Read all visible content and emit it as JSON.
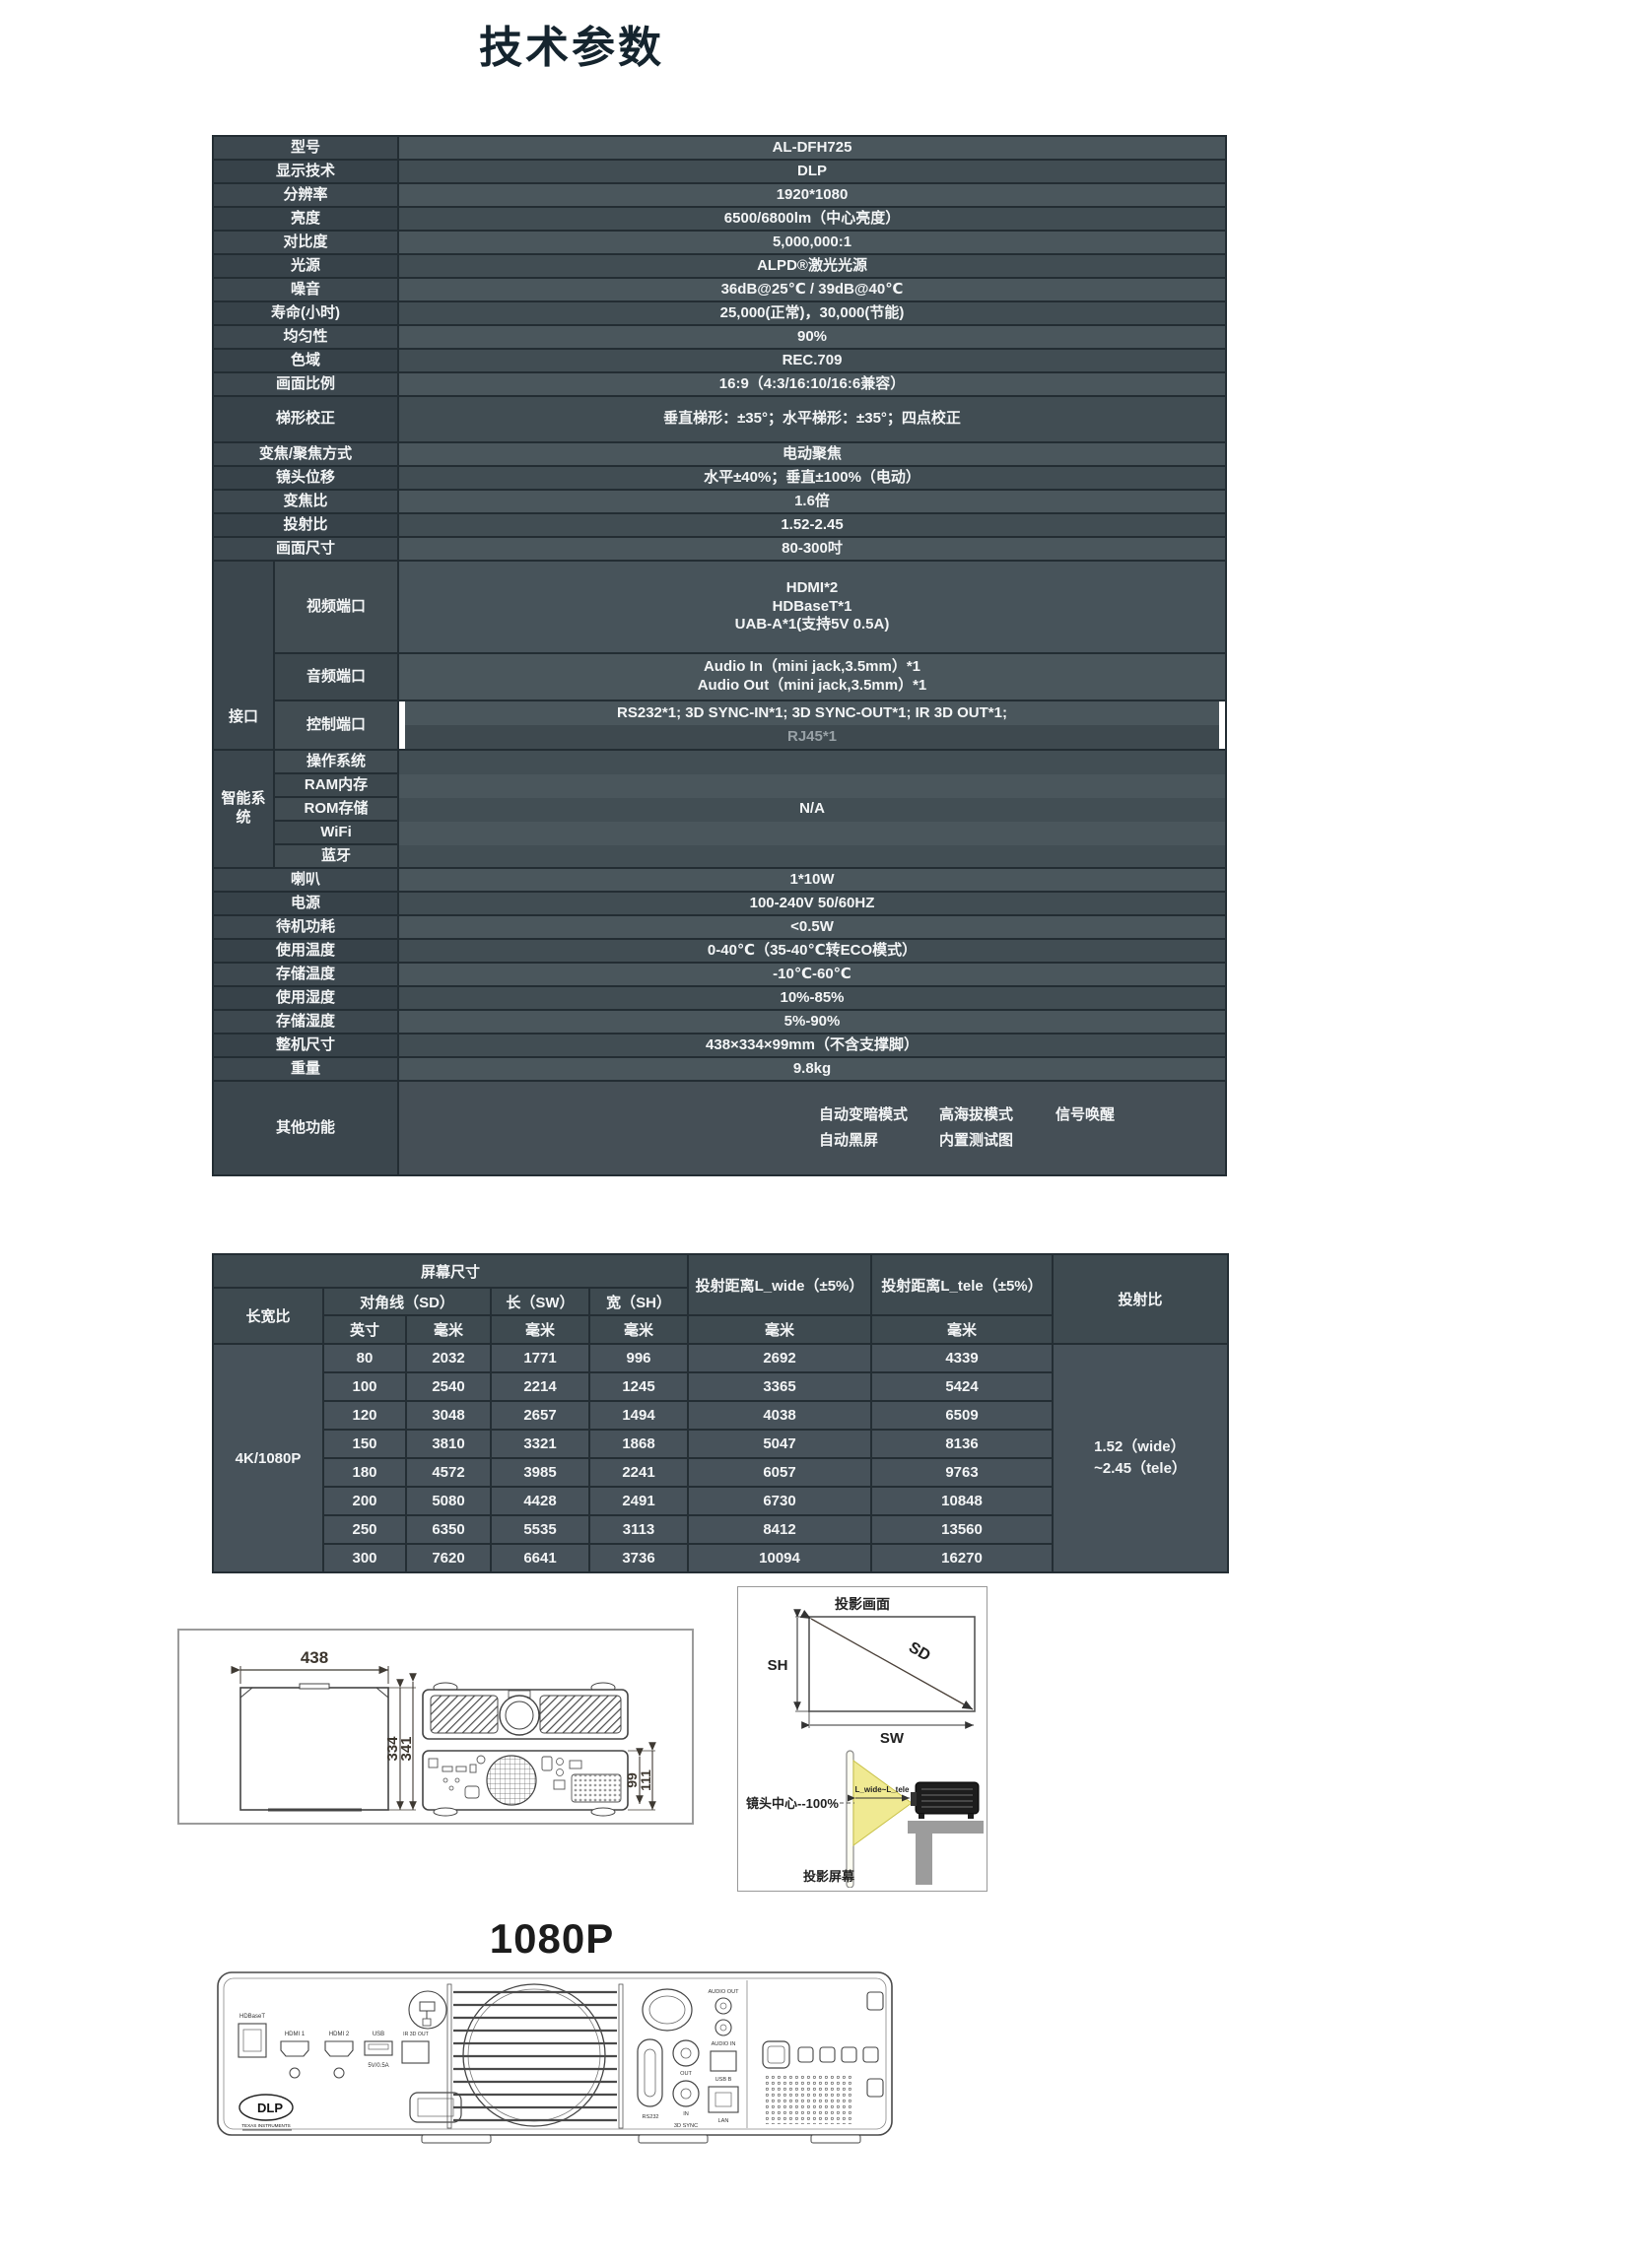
{
  "page": {
    "title": "技术参数",
    "model_banner": "1080P"
  },
  "spec_table": {
    "rows1": [
      {
        "label": "型号",
        "value": "AL-DFH725"
      },
      {
        "label": "显示技术",
        "value": "DLP"
      },
      {
        "label": "分辨率",
        "value": "1920*1080"
      },
      {
        "label": "亮度",
        "value": "6500/6800lm（中心亮度）"
      },
      {
        "label": "对比度",
        "value": "5,000,000:1"
      },
      {
        "label": "光源",
        "value": "ALPD®激光光源"
      },
      {
        "label": "噪音",
        "value": "36dB@25℃ / 39dB@40℃"
      },
      {
        "label": "寿命(小时)",
        "value": "25,000(正常)，30,000(节能)"
      },
      {
        "label": "均匀性",
        "value": "90%"
      },
      {
        "label": "色域",
        "value": "REC.709"
      },
      {
        "label": "画面比例",
        "value": "16:9（4:3/16:10/16:6兼容）"
      },
      {
        "label": "梯形校正",
        "value": "垂直梯形：±35°；水平梯形：±35°；四点校正"
      },
      {
        "label": "变焦/聚焦方式",
        "value": "电动聚焦"
      },
      {
        "label": "镜头位移",
        "value": "水平±40%；垂直±100%（电动）"
      },
      {
        "label": "变焦比",
        "value": "1.6倍"
      },
      {
        "label": "投射比",
        "value": "1.52-2.45"
      },
      {
        "label": "画面尺寸",
        "value": "80-300吋"
      }
    ],
    "interface": {
      "group_label": "接口",
      "video_label": "视频端口",
      "video_line1": "HDMI*2",
      "video_line2": "HDBaseT*1",
      "video_line3": "UAB-A*1(支持5V 0.5A)",
      "audio_label": "音频端口",
      "audio_line1": "Audio In（mini jack,3.5mm）*1",
      "audio_line2": "Audio Out（mini jack,3.5mm）*1",
      "control_label": "控制端口",
      "control_line1": "RS232*1;  3D SYNC-IN*1;  3D SYNC-OUT*1;  IR 3D OUT*1;",
      "control_line2": "RJ45*1"
    },
    "smart": {
      "group_label": "智能系统",
      "row1": "操作系统",
      "row2": "RAM内存",
      "row3": "ROM存储",
      "row4": "WiFi",
      "row5": "蓝牙",
      "value": "N/A"
    },
    "rows2": [
      {
        "label": "喇叭",
        "value": "1*10W"
      },
      {
        "label": "电源",
        "value": "100-240V 50/60HZ"
      },
      {
        "label": "待机功耗",
        "value": "<0.5W"
      },
      {
        "label": "使用温度",
        "value": "0-40℃（35-40℃转ECO模式）"
      },
      {
        "label": "存储温度",
        "value": "-10℃-60℃"
      },
      {
        "label": "使用湿度",
        "value": "10%-85%"
      },
      {
        "label": "存储湿度",
        "value": "5%-90%"
      },
      {
        "label": "整机尺寸",
        "value": "438×334×99mm（不含支撑脚）"
      },
      {
        "label": "重量",
        "value": "9.8kg"
      }
    ],
    "other": {
      "label": "其他功能",
      "item1": "自动变暗模式",
      "item2": "高海拔模式",
      "item3": "信号唤醒",
      "item4": "自动黑屏",
      "item5": "内置测试图"
    }
  },
  "distance_table": {
    "h_screen": "屏幕尺寸",
    "h_aspect": "长宽比",
    "h_diag": "对角线（SD）",
    "h_len": "长（SW）",
    "h_wid": "宽（SH）",
    "h_lwide": "投射距离L_wide（±5%）",
    "h_ltele": "投射距离L_tele（±5%）",
    "h_ratio": "投射比",
    "u_inch": "英寸",
    "u_mm1": "毫米",
    "u_mm2": "毫米",
    "u_mm3": "毫米",
    "u_mm4": "毫米",
    "u_mm5": "毫米",
    "aspect": "4K/1080P",
    "ratio_line1": "1.52（wide）",
    "ratio_line2": "~2.45（tele）",
    "rows": [
      [
        "80",
        "2032",
        "1771",
        "996",
        "2692",
        "4339"
      ],
      [
        "100",
        "2540",
        "2214",
        "1245",
        "3365",
        "5424"
      ],
      [
        "120",
        "3048",
        "2657",
        "1494",
        "4038",
        "6509"
      ],
      [
        "150",
        "3810",
        "3321",
        "1868",
        "5047",
        "8136"
      ],
      [
        "180",
        "4572",
        "3985",
        "2241",
        "6057",
        "9763"
      ],
      [
        "200",
        "5080",
        "4428",
        "2491",
        "6730",
        "10848"
      ],
      [
        "250",
        "6350",
        "5535",
        "3113",
        "8412",
        "13560"
      ],
      [
        "300",
        "7620",
        "6641",
        "3736",
        "10094",
        "16270"
      ]
    ]
  },
  "dim_diagram": {
    "top_width": "438",
    "side_h_inner": "334",
    "side_h_outer": "341",
    "rear_h_inner": "99",
    "rear_h_outer": "111"
  },
  "projection_diagram": {
    "title": "投影画面",
    "sh": "SH",
    "sd": "SD",
    "sw": "SW",
    "lens_center": "镜头中心--100%",
    "throw_range": "L_wide~L_tele",
    "screen_label": "投影屏幕"
  },
  "rear_panel": {
    "hdbaset": "HDBaseT",
    "hdmi1": "HDMI 1",
    "hdmi2": "HDMI 2",
    "usb": "USB",
    "usb_power": "5V/0.5A",
    "ir3dout": "IR 3D OUT",
    "rs232": "RS232",
    "sync_out": "OUT",
    "sync_in": "IN",
    "sync": "3D SYNC",
    "audio_out": "AUDIO OUT",
    "audio_in": "AUDIO IN",
    "usbb": "USB B",
    "lan": "LAN",
    "dlp": "DLP",
    "ti": "TEXAS INSTRUMENTS"
  }
}
